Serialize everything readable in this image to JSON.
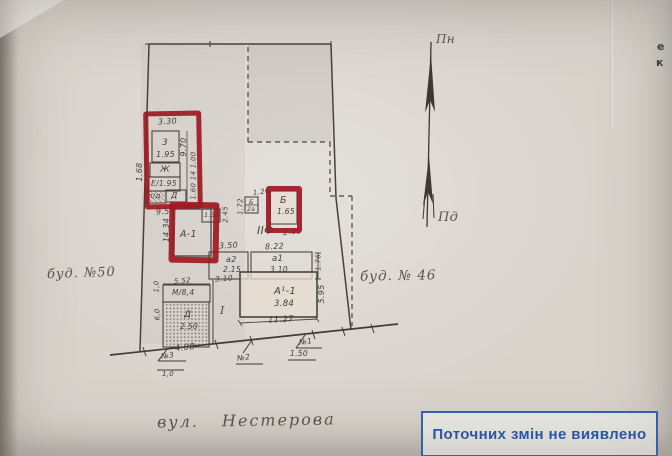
{
  "context": {
    "left_neighbor": "буд. №50",
    "right_neighbor": "буд. № 46",
    "street": "вул. Нестерова"
  },
  "compass": {
    "north_label": "Пн",
    "south_label": "Пд"
  },
  "stamp": {
    "text": "Поточних змін не виявлено",
    "ink_color": "#2a55a4"
  },
  "highlight": {
    "marker_color": "#9e1a22",
    "box_count": 3
  },
  "edge_text": {
    "line1": "е",
    "line2": "к"
  },
  "labels": {
    "dim_3_30": "3.30",
    "room_3": "3",
    "room_3_h": "1.95",
    "dim_9_70": "9.70",
    "zh": "Ж",
    "e_1_95": "Е/1.95",
    "pd": "п/д",
    "d_top": "Д",
    "side_dims": "1.60 14 1.00",
    "dim_1_68": "1.68",
    "dim_9_50": "9.50",
    "a1_shed": "А-1",
    "dim_14_34": "14.34",
    "dim_1_30": "1.30",
    "dim_2_45": "2.45",
    "dim_3_50": "3.50",
    "dim_1_26": "1.26",
    "dim_1_72": "1.72",
    "b_small": "Б",
    "b_small_2": "2а",
    "b_main": "Б",
    "b_main_h": "1.65",
    "dim_2_85": "2.85",
    "section_iif": "ІІФ",
    "dim_8_22": "8.22",
    "a2_porch": "а2",
    "a2_porch_h": "2.15",
    "a1_porch": "а1",
    "a1_porch_h": "3.10",
    "dim_1_76": "1.76",
    "dim_3_10": "3.10",
    "main_house": "А¹-1",
    "main_house_h": "3.84",
    "dim_5_95": "5.95",
    "dim_11_27": "11.27",
    "yard_mark": "І",
    "m_block": "М/8,4",
    "dim_5_52": "5.52",
    "dim_1_0_side": "1,0",
    "dim_6_0_side": "6,0",
    "d_hatched": "Д",
    "d_hatched_h": "2.50",
    "dim_4_08": "4.08",
    "mark_no3": "№3",
    "mark_no3_v": "1,0",
    "mark_no2": "№2",
    "mark_no1": "№1",
    "mark_no1_v": "1.50"
  }
}
